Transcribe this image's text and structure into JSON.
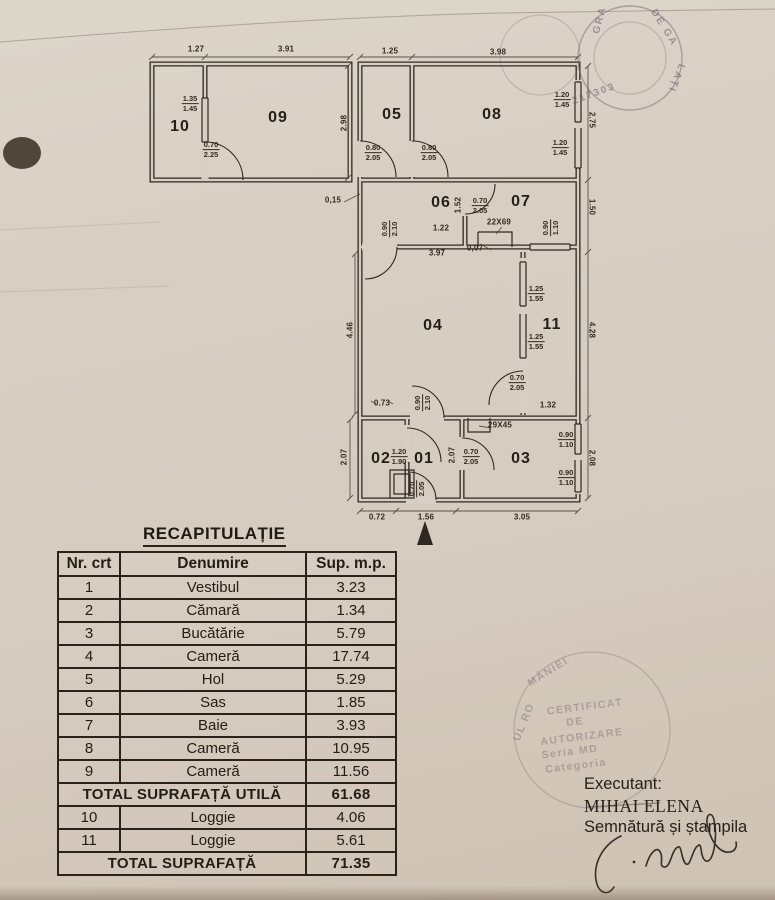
{
  "table": {
    "title": "RECAPITULAȚIE",
    "headers": [
      "Nr. crt",
      "Denumire",
      "Sup. m.p."
    ],
    "rows": [
      {
        "nr": "1",
        "name": "Vestibul",
        "area": "3.23"
      },
      {
        "nr": "2",
        "name": "Cămară",
        "area": "1.34"
      },
      {
        "nr": "3",
        "name": "Bucătărie",
        "area": "5.79"
      },
      {
        "nr": "4",
        "name": "Cameră",
        "area": "17.74"
      },
      {
        "nr": "5",
        "name": "Hol",
        "area": "5.29"
      },
      {
        "nr": "6",
        "name": "Sas",
        "area": "1.85"
      },
      {
        "nr": "7",
        "name": "Baie",
        "area": "3.93"
      },
      {
        "nr": "8",
        "name": "Cameră",
        "area": "10.95"
      },
      {
        "nr": "9",
        "name": "Cameră",
        "area": "11.56"
      },
      {
        "total": "TOTAL SUPRAFAȚĂ UTILĂ",
        "area": "61.68"
      },
      {
        "nr": "10",
        "name": "Loggie",
        "area": "4.06"
      },
      {
        "nr": "11",
        "name": "Loggie",
        "area": "5.61"
      },
      {
        "total": "TOTAL SUPRAFAȚĂ",
        "area": "71.35"
      }
    ]
  },
  "signature_block": {
    "executant_label": "Executant:",
    "name": "MIHAI ELENA",
    "signature_label": "Semnătură și ștampila"
  },
  "floorplan": {
    "room_labels": [
      {
        "t": "10",
        "x": 180,
        "y": 127
      },
      {
        "t": "09",
        "x": 278,
        "y": 118
      },
      {
        "t": "05",
        "x": 392,
        "y": 115
      },
      {
        "t": "08",
        "x": 492,
        "y": 115
      },
      {
        "t": "06",
        "x": 441,
        "y": 203
      },
      {
        "t": "07",
        "x": 521,
        "y": 202
      },
      {
        "t": "04",
        "x": 433,
        "y": 326
      },
      {
        "t": "11",
        "x": 552,
        "y": 325
      },
      {
        "t": "02",
        "x": 381,
        "y": 459
      },
      {
        "t": "01",
        "x": 424,
        "y": 459
      },
      {
        "t": "03",
        "x": 521,
        "y": 459
      }
    ],
    "dim_labels": [
      {
        "t": "1.27",
        "x": 196,
        "y": 49
      },
      {
        "t": "3.91",
        "x": 286,
        "y": 49
      },
      {
        "t": "1.25",
        "x": 390,
        "y": 51
      },
      {
        "t": "3.98",
        "x": 498,
        "y": 52
      },
      {
        "t": "2.98",
        "x": 344,
        "y": 123,
        "r": -90
      },
      {
        "t": "0,15",
        "x": 333,
        "y": 200
      },
      {
        "t": "1.22",
        "x": 441,
        "y": 228
      },
      {
        "t": "22X69",
        "x": 499,
        "y": 222
      },
      {
        "t": "1.52",
        "x": 458,
        "y": 205,
        "r": -90
      },
      {
        "t": "3.97",
        "x": 437,
        "y": 253
      },
      {
        "t": "0,07",
        "x": 475,
        "y": 248
      },
      {
        "t": "4.46",
        "x": 350,
        "y": 330,
        "r": -90
      },
      {
        "t": "2.75",
        "x": 592,
        "y": 120,
        "r": 90
      },
      {
        "t": "1.50",
        "x": 592,
        "y": 207,
        "r": 90
      },
      {
        "t": "4.28",
        "x": 592,
        "y": 330,
        "r": 90
      },
      {
        "t": "2.08",
        "x": 592,
        "y": 458,
        "r": 90
      },
      {
        "t": "1.32",
        "x": 548,
        "y": 405
      },
      {
        "t": "0.73",
        "x": 382,
        "y": 403
      },
      {
        "t": "29X45",
        "x": 500,
        "y": 425
      },
      {
        "t": "2.07",
        "x": 344,
        "y": 457,
        "r": -90
      },
      {
        "t": "2.07",
        "x": 452,
        "y": 455,
        "r": -90
      },
      {
        "t": "0.72",
        "x": 377,
        "y": 517
      },
      {
        "t": "1.56",
        "x": 426,
        "y": 517
      },
      {
        "t": "3.05",
        "x": 522,
        "y": 517
      }
    ],
    "door_labels": [
      {
        "a": "1.35",
        "b": "1.45",
        "x": 190,
        "y": 104
      },
      {
        "a": "0.70",
        "b": "2.25",
        "x": 211,
        "y": 150
      },
      {
        "a": "0.80",
        "b": "2.05",
        "x": 373,
        "y": 153
      },
      {
        "a": "0.80",
        "b": "2.05",
        "x": 429,
        "y": 153
      },
      {
        "a": "1.20",
        "b": "1.45",
        "x": 562,
        "y": 100
      },
      {
        "a": "1.20",
        "b": "1.45",
        "x": 560,
        "y": 148
      },
      {
        "a": "0.70",
        "b": "2.05",
        "x": 480,
        "y": 206
      },
      {
        "a": "0.90",
        "b": "2.10",
        "x": 390,
        "y": 229,
        "r": -90
      },
      {
        "a": "0.90",
        "b": "1.10",
        "x": 551,
        "y": 228,
        "r": -90
      },
      {
        "a": "1.25",
        "b": "1.55",
        "x": 536,
        "y": 294
      },
      {
        "a": "1.25",
        "b": "1.55",
        "x": 536,
        "y": 342
      },
      {
        "a": "0.70",
        "b": "2.05",
        "x": 517,
        "y": 383
      },
      {
        "a": "0.90",
        "b": "2.10",
        "x": 423,
        "y": 403,
        "r": -90
      },
      {
        "a": "1.20",
        "b": "1.90",
        "x": 399,
        "y": 457
      },
      {
        "a": "0.70",
        "b": "2.05",
        "x": 471,
        "y": 457
      },
      {
        "a": "0.90",
        "b": "1.10",
        "x": 566,
        "y": 440
      },
      {
        "a": "0.90",
        "b": "1.10",
        "x": 566,
        "y": 478
      },
      {
        "a": "0.70",
        "b": "2.05",
        "x": 417,
        "y": 489,
        "r": -90
      }
    ]
  },
  "stamps": {
    "top_right": {
      "fragments": [
        {
          "t": "DE GA",
          "x": 664,
          "y": 28,
          "r": 58
        },
        {
          "t": "LAȚI",
          "x": 676,
          "y": 78,
          "r": 112
        },
        {
          "t": "217303",
          "x": 594,
          "y": 94,
          "r": -20
        },
        {
          "t": "GRA",
          "x": 600,
          "y": 20,
          "r": -75
        }
      ]
    },
    "bottom": {
      "fragments": [
        {
          "t": "UL RO",
          "x": 524,
          "y": 722,
          "r": -68
        },
        {
          "t": "MÂNIEI",
          "x": 548,
          "y": 672,
          "r": -32
        },
        {
          "t": "CERTIFICAT",
          "x": 585,
          "y": 707,
          "r": -7
        },
        {
          "t": "DE",
          "x": 575,
          "y": 722,
          "r": -7
        },
        {
          "t": "AUTORIZARE",
          "x": 582,
          "y": 737,
          "r": -7
        },
        {
          "t": "Seria MD",
          "x": 570,
          "y": 752,
          "r": -7
        },
        {
          "t": "Categoria",
          "x": 576,
          "y": 766,
          "r": -7
        }
      ]
    }
  }
}
